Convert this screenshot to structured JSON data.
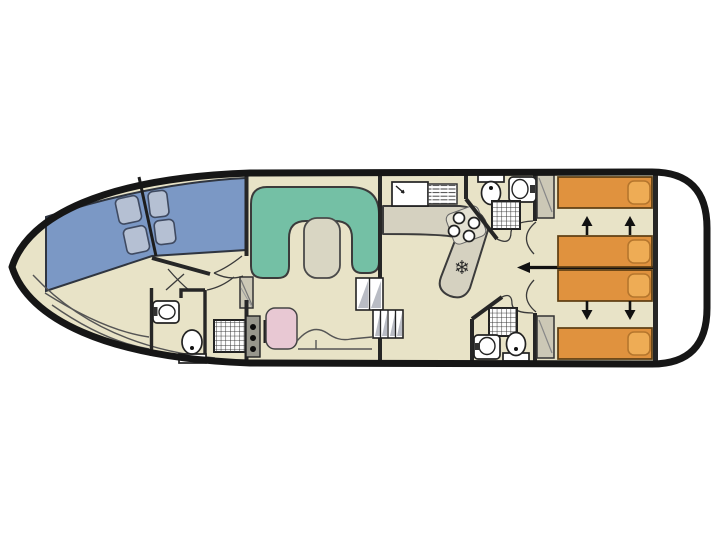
{
  "diagram": {
    "type": "boat-floor-plan",
    "orientation": "bow-left-stern-right",
    "decks": 1
  },
  "palette": {
    "hull": "#161616",
    "wall": "#262626",
    "floor": "#e8e3c7",
    "deck_white": "#ffffff",
    "windshield": "#7b98c5",
    "cushion": "#b5c0d3",
    "cushion_edge": "#3f4a61",
    "sofa": "#74c0a5",
    "sofa_edge": "#3b3b3b",
    "table": "#d9d6c3",
    "bed": "#e0923e",
    "bed_edge": "#5d3d12",
    "pillow": "#eeac55",
    "pillow_edge": "#b5762d",
    "counter": "#d5d1c0",
    "chair_pink": "#e8c8d3",
    "wardrobe": "#ccc8b6",
    "appliance": "#ffffff",
    "fixture_edge": "#222222",
    "heater": "#97968c",
    "step_shade": "#b9bcc4",
    "line_thin": "#555555"
  },
  "icons": {
    "fridge_snowflake": "❄"
  },
  "inventory": {
    "bow_cockpit": {
      "windshield_panels": 2,
      "seat_cushions": 4,
      "curved_bench_lines": 2
    },
    "forward_bathroom": {
      "washbasin": 1,
      "toilet": 1,
      "shower": 1,
      "wardrobe": 1
    },
    "saloon": {
      "u_sofa": 1,
      "table": 1,
      "pink_seat": 1,
      "heater_knobs": 3,
      "step_flights": 2
    },
    "galley": {
      "sink": 1,
      "drainer": 1,
      "hob_burners": 4,
      "fridge": 1
    },
    "aft_cabin_top": {
      "beds": 2,
      "pillows": 2,
      "slide_arrows_up": 2,
      "wardrobe": 1
    },
    "aft_cabin_bottom": {
      "beds": 2,
      "pillows": 2,
      "slide_arrows_down": 2,
      "wardrobe": 1
    },
    "aft_bathroom_top": {
      "toilet": 1,
      "washbasin": 1,
      "shower": 1
    },
    "aft_bathroom_bottom": {
      "toilet": 1,
      "washbasin": 1,
      "shower": 1
    },
    "corridor": {
      "centerline_arrow": 1
    },
    "stern_deck": {
      "open_white_deck": 1
    }
  }
}
